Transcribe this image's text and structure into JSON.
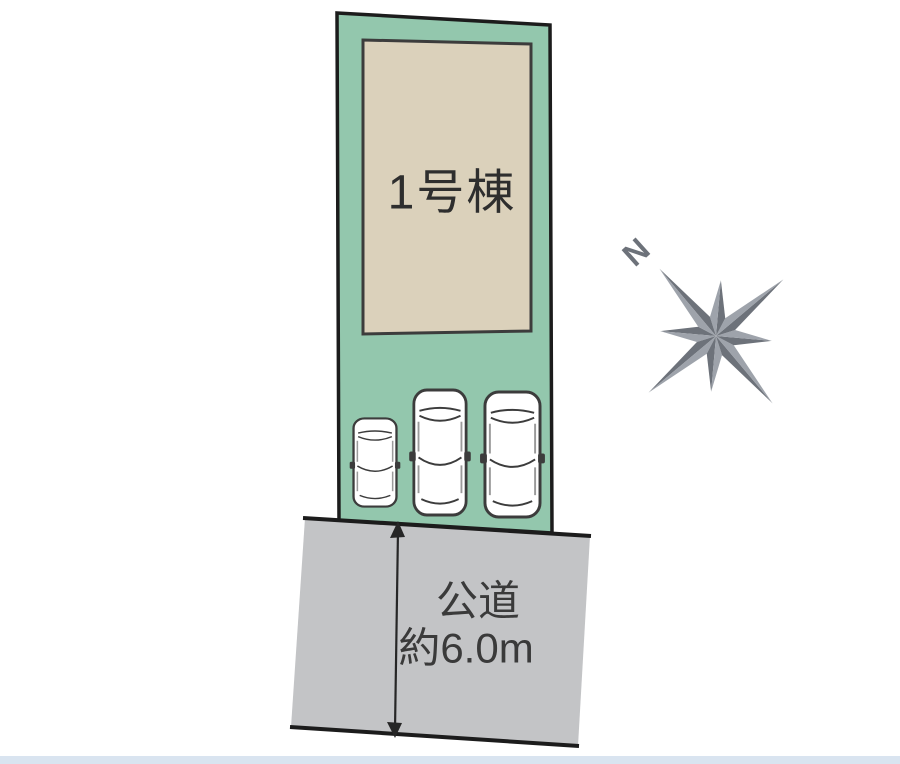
{
  "site_plan": {
    "building_label": "1号棟",
    "road_label": {
      "line1": "公道",
      "line2": "約6.0m"
    },
    "compass": {
      "north_label": "N"
    },
    "cars": {
      "count": 3
    },
    "colors": {
      "lot_fill": "#93c7ad",
      "building_fill": "#dbd1bb",
      "road_fill": "#c3c4c6",
      "outline": "#1c1c1c",
      "building_outline": "#3c3c3c",
      "car_outline": "#3c3c3c",
      "compass_dark": "#6d727a",
      "compass_light": "#9ea3ab",
      "label_text": "#2e2e2e",
      "bottom_strip": "#d9e4f0"
    }
  }
}
